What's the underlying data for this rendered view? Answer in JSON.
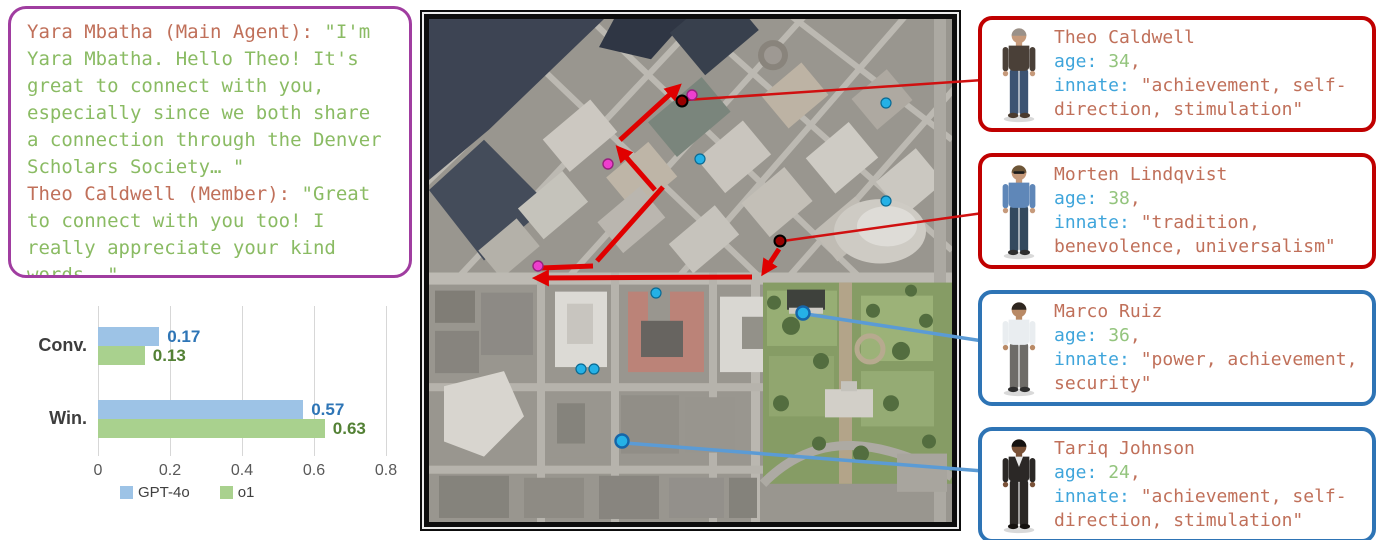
{
  "dialogue": {
    "border_color": "#A03DA0",
    "speaker_color": "#C0705A",
    "text_color": "#8ABB63",
    "turns": [
      {
        "speaker": "Yara Mbatha (Main Agent):",
        "text": "\"I'm Yara Mbatha. Hello Theo! It's great to connect with you, especially since we both share a connection through the Denver Scholars Society… \""
      },
      {
        "speaker": "Theo Caldwell (Member):",
        "text": "\"Great to connect with you too! I really appreciate your kind words… \""
      }
    ]
  },
  "chart_data": {
    "type": "bar",
    "orientation": "horizontal",
    "title": "",
    "categories": [
      "Conv.",
      "Win."
    ],
    "series": [
      {
        "name": "GPT-4o",
        "color": "#9DC3E6",
        "label_color": "#2E75B6",
        "values": [
          0.17,
          0.57
        ]
      },
      {
        "name": "o1",
        "color": "#A9D18E",
        "label_color": "#538135",
        "values": [
          0.13,
          0.63
        ]
      }
    ],
    "xlim": [
      0,
      0.8
    ],
    "xticks": [
      "0",
      "0.2",
      "0.4",
      "0.6",
      "0.8"
    ],
    "grid": true,
    "legend_position": "bottom"
  },
  "map": {
    "dot_colors": {
      "magenta": "#EE3FCE",
      "darkred": "#990000",
      "cyan": "#25B1E6"
    },
    "arrow_color": "#E00000",
    "connector_red": "#D01010",
    "connector_blue": "#5B9BD5",
    "dots": [
      {
        "x": 692,
        "y": 95,
        "type": "magenta"
      },
      {
        "x": 608,
        "y": 164,
        "type": "magenta"
      },
      {
        "x": 538,
        "y": 266,
        "type": "magenta"
      },
      {
        "x": 682,
        "y": 101,
        "type": "darkred"
      },
      {
        "x": 780,
        "y": 241,
        "type": "darkred"
      },
      {
        "x": 700,
        "y": 159,
        "type": "cyan"
      },
      {
        "x": 886,
        "y": 103,
        "type": "cyan"
      },
      {
        "x": 886,
        "y": 201,
        "type": "cyan"
      },
      {
        "x": 656,
        "y": 293,
        "type": "cyan"
      },
      {
        "x": 581,
        "y": 369,
        "type": "cyan"
      },
      {
        "x": 594,
        "y": 369,
        "type": "cyan"
      },
      {
        "x": 803,
        "y": 313,
        "type": "cyan-large"
      },
      {
        "x": 622,
        "y": 441,
        "type": "cyan-large"
      }
    ],
    "path_arrows": [
      {
        "x1": 620,
        "y1": 140,
        "x2": 678,
        "y2": 87,
        "head": true
      },
      {
        "x1": 655,
        "y1": 190,
        "x2": 619,
        "y2": 149,
        "head": true
      },
      {
        "x1": 663,
        "y1": 187,
        "x2": 597,
        "y2": 261,
        "head": false
      },
      {
        "x1": 541,
        "y1": 268,
        "x2": 593,
        "y2": 266,
        "head": false
      },
      {
        "x1": 752,
        "y1": 277,
        "x2": 537,
        "y2": 278,
        "head": true
      },
      {
        "x1": 779,
        "y1": 249,
        "x2": 764,
        "y2": 272,
        "head": true
      }
    ],
    "connectors": [
      {
        "x1": 686,
        "y1": 100,
        "x2": 983,
        "y2": 80,
        "color": "red"
      },
      {
        "x1": 783,
        "y1": 241,
        "x2": 983,
        "y2": 213,
        "color": "red"
      },
      {
        "x1": 806,
        "y1": 314,
        "x2": 983,
        "y2": 341,
        "color": "blue"
      },
      {
        "x1": 625,
        "y1": 443,
        "x2": 983,
        "y2": 471,
        "color": "blue"
      }
    ]
  },
  "cards": {
    "age_label": "age:",
    "age_suffix": ",",
    "innate_label": "innate:",
    "name_color": "#C0705A",
    "label_color": "#3FA5DB",
    "age_color": "#93C47D",
    "value_color": "#C0705A",
    "items": [
      {
        "name": "Theo Caldwell",
        "age": "34",
        "innate": "\"achievement, self-direction, stimulation\"",
        "border_color": "#C00000",
        "avatar": {
          "skin": "#C69A7B",
          "hair": "#9A9189",
          "top": "#4A4038",
          "bottom": "#3C5372",
          "shoes": "#4A3B2F",
          "accessory": "none"
        }
      },
      {
        "name": "Morten Lindqvist",
        "age": "38",
        "innate": "\"tradition, benevolence, universalism\"",
        "border_color": "#C00000",
        "avatar": {
          "skin": "#C69A7B",
          "hair": "#6D5638",
          "top": "#5F87B8",
          "bottom": "#33495E",
          "shoes": "#2F2F2F",
          "accessory": "sunglasses"
        }
      },
      {
        "name": "Marco Ruiz",
        "age": "36",
        "innate": "\"power, achievement, security\"",
        "border_color": "#2E74B5",
        "avatar": {
          "skin": "#B98A66",
          "hair": "#2E2620",
          "top": "#E9EDF0",
          "bottom": "#6E6C68",
          "shoes": "#2F2F2F",
          "accessory": "none"
        }
      },
      {
        "name": "Tariq Johnson",
        "age": "24",
        "innate": "\"achievement, self-direction, stimulation\"",
        "border_color": "#2E74B5",
        "avatar": {
          "skin": "#7A5238",
          "hair": "#151210",
          "top": "#2B2826",
          "bottom": "#2B2826",
          "shoes": "#151210",
          "accessory": "suit"
        }
      }
    ]
  }
}
